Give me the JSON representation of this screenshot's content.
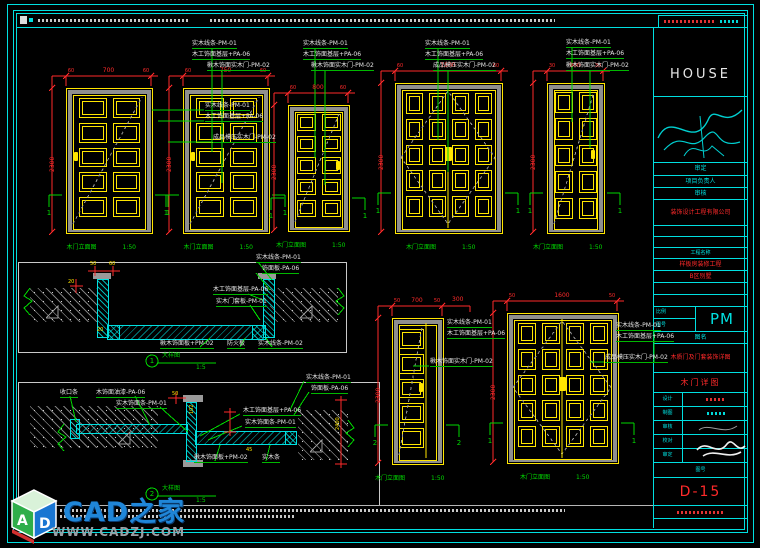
{
  "colors": {
    "cyan": "#00dfe0",
    "yellow": "#ffe600",
    "red": "#ff2a2a",
    "green": "#00d900",
    "gray": "#9a9a9a",
    "white": "#e6e6e6",
    "wm_blue": "#1f86d8"
  },
  "logo": {
    "text": "HOUSE"
  },
  "watermark": {
    "brand": "CAD之家",
    "url": "WWW.CADZJ.COM",
    "cube_letter_a": "A",
    "cube_letter_d": "D"
  },
  "title_block": {
    "logo": "HOUSE",
    "r1": "审定",
    "r2": "项目负责人",
    "r3": "审核",
    "company": "装饰设计工程有限公司",
    "proj_label": "工程名称",
    "proj1": "样板房装修工程",
    "proj2": "B区别墅",
    "scale_label": "比例",
    "no_label": "图号",
    "pm": "PM",
    "name_label": "图名",
    "sheet_long": "木质门及门套装饰详图",
    "sheet": "木门详图",
    "sig": [
      "设计",
      "制图",
      "审核",
      "校对",
      "审定"
    ],
    "no_label2": "图号",
    "number": "D-15"
  },
  "doors": [
    {
      "x": 66,
      "y": 88,
      "w": 85,
      "h": 144,
      "cols": 2,
      "rows": 5,
      "leaves": 1,
      "handle": "l",
      "dim_top": "700",
      "dim_sides": [
        "60",
        "60"
      ],
      "dim_left": "2300",
      "section": "1",
      "caption": "木门立面图",
      "scale": "1:50",
      "pad": [
        12,
        12,
        9,
        16
      ]
    },
    {
      "x": 183,
      "y": 88,
      "w": 85,
      "h": 144,
      "cols": 2,
      "rows": 5,
      "leaves": 1,
      "handle": "l",
      "dim_top": "750",
      "dim_sides": [
        "60",
        "60"
      ],
      "dim_left": "2300",
      "section": "1",
      "caption": "木门立面图",
      "scale": "1:50",
      "pad": [
        12,
        12,
        9,
        16
      ]
    },
    {
      "x": 288,
      "y": 105,
      "w": 60,
      "h": 125,
      "cols": 2,
      "rows": 5,
      "leaves": 1,
      "handle": "r",
      "dim_top": "800",
      "dim_sides": [
        "60",
        "60"
      ],
      "dim_left": "2300",
      "section": "1",
      "caption": "木门立面图",
      "scale": "1:50",
      "pad": [
        8,
        8,
        8,
        14
      ]
    },
    {
      "x": 395,
      "y": 83,
      "w": 106,
      "h": 149,
      "cols": 4,
      "rows": 5,
      "leaves": 2,
      "handle": "c",
      "dim_top": "1500",
      "dim_sides": [
        "60",
        "60"
      ],
      "dim_left": "2300",
      "section": "1",
      "caption": "木门立面图",
      "scale": "1:50",
      "pad": [
        10,
        10,
        9,
        16
      ]
    },
    {
      "x": 547,
      "y": 83,
      "w": 56,
      "h": 149,
      "cols": 2,
      "rows": 5,
      "leaves": 1,
      "handle": "r",
      "dim_top": "900",
      "dim_sides": [
        "30",
        "30"
      ],
      "dim_left": "2300",
      "section": "1",
      "caption": "木门立面图",
      "scale": "1:50",
      "pad": [
        7,
        7,
        8,
        14
      ]
    },
    {
      "x": 392,
      "y": 318,
      "w": 50,
      "h": 145,
      "cols": 1,
      "rows": 5,
      "leaves": 1,
      "handle": "lc",
      "dim_top": "700",
      "dim_sides": [
        "50",
        "50"
      ],
      "dim_left": "2300",
      "section": "2",
      "divider": true,
      "caption": "木门立面图",
      "scale": "1:50",
      "pad": [
        6,
        19,
        10,
        16
      ]
    },
    {
      "x": 507,
      "y": 313,
      "w": 110,
      "h": 149,
      "cols": 4,
      "rows": 5,
      "leaves": 2,
      "handle": "c",
      "dim_top": "1600",
      "dim_sides": [
        "50",
        "50"
      ],
      "dim_left": "2300",
      "section": "1",
      "caption": "木门立面图",
      "scale": "1:50",
      "pad": [
        10,
        10,
        9,
        16
      ]
    }
  ],
  "labels": [
    [
      205,
      103,
      "实木线条-PM-01",
      "w",
      6,
      "u"
    ],
    [
      205,
      114,
      "木工饰面基层+PA-06",
      "w",
      6,
      "u"
    ],
    [
      213,
      135,
      "成品模压实木门-PM-02",
      "w",
      6,
      "u"
    ],
    [
      192,
      41,
      "实木线条-PM-01",
      "w",
      6,
      "u"
    ],
    [
      192,
      52,
      "木工饰面基层+PA-06",
      "w",
      6,
      "u"
    ],
    [
      207,
      63,
      "楸木饰面实木门-PM-02",
      "w",
      6,
      "u"
    ],
    [
      303,
      41,
      "实木线条-PM-01",
      "w",
      6,
      "u"
    ],
    [
      303,
      52,
      "木工饰面基层+PA-06",
      "w",
      6,
      "u"
    ],
    [
      311,
      63,
      "楸木饰面实木门-PM-02",
      "w",
      6,
      "u"
    ],
    [
      425,
      41,
      "实木线条-PM-01",
      "w",
      6,
      "u"
    ],
    [
      425,
      52,
      "木工饰面基层+PA-06",
      "w",
      6,
      "u"
    ],
    [
      433,
      63,
      "成品模压实木门-PM-02",
      "w",
      6,
      "u"
    ],
    [
      566,
      40,
      "实木线条-PM-01",
      "w",
      6,
      "u"
    ],
    [
      566,
      51,
      "木工饰面基层+PA-06",
      "w",
      6,
      "u"
    ],
    [
      566,
      63,
      "楸木饰面实木门-PM-02",
      "w",
      6,
      "u"
    ],
    [
      447,
      320,
      "实木线条-PM-01",
      "w",
      6,
      "u"
    ],
    [
      447,
      331,
      "木工饰面基层+PA-06",
      "w",
      6,
      "u"
    ],
    [
      430,
      359,
      "楸木饰面实木门-PM-02",
      "w",
      6,
      "u"
    ],
    [
      616,
      323,
      "实木线条-PM-01",
      "w",
      6,
      "u"
    ],
    [
      616,
      334,
      "木工饰面基层+PA-06",
      "w",
      6,
      "u"
    ],
    [
      605,
      355,
      "成品模压实木门-PM-02",
      "w",
      6,
      "u"
    ],
    [
      256,
      255,
      "实木线条-PM-01",
      "w",
      6,
      "u"
    ],
    [
      262,
      266,
      "饰面板-PA-06",
      "w",
      6,
      "u"
    ],
    [
      213,
      287,
      "木工饰面基层-PA-06",
      "w",
      6,
      "u"
    ],
    [
      216,
      299,
      "实木门套板-PM-01",
      "w",
      6,
      "u"
    ],
    [
      160,
      341,
      "楸木饰面板+PM-02",
      "w",
      6,
      "u"
    ],
    [
      227,
      341,
      "防火板",
      "w",
      6,
      "u"
    ],
    [
      258,
      341,
      "实木线条-PM-02",
      "w",
      6,
      "u"
    ],
    [
      162,
      353,
      "大样图",
      "g",
      6,
      ""
    ],
    [
      196,
      365,
      "1:5",
      "g",
      6,
      ""
    ],
    [
      152,
      358,
      "1",
      "g",
      7,
      "c"
    ],
    [
      60,
      390,
      "收口条",
      "w",
      6,
      "u"
    ],
    [
      96,
      390,
      "木饰面油漆-PA-06",
      "w",
      6,
      "u"
    ],
    [
      116,
      401,
      "实木饰面条-PM-01",
      "w",
      6,
      "u"
    ],
    [
      243,
      408,
      "木工饰面基层+PA-06",
      "w",
      6,
      "u"
    ],
    [
      245,
      420,
      "实木饰面条-PM-01",
      "w",
      6,
      "u"
    ],
    [
      306,
      375,
      "实木线条-PM-01",
      "w",
      6,
      "u"
    ],
    [
      311,
      386,
      "饰面板-PA-06",
      "w",
      6,
      "u"
    ],
    [
      194,
      455,
      "楸木饰面板+PM-02",
      "w",
      6,
      "u"
    ],
    [
      262,
      455,
      "实木条",
      "w",
      6,
      "u"
    ],
    [
      162,
      486,
      "大样图",
      "g",
      6,
      ""
    ],
    [
      196,
      498,
      "1:5",
      "g",
      6,
      ""
    ],
    [
      152,
      491,
      "2",
      "g",
      7,
      "c"
    ],
    [
      90,
      262,
      "50",
      "y",
      5,
      ""
    ],
    [
      109,
      262,
      "60",
      "y",
      5,
      ""
    ],
    [
      68,
      280,
      "20",
      "y",
      5,
      ""
    ],
    [
      97,
      328,
      "20",
      "y",
      5,
      ""
    ],
    [
      172,
      392,
      "50",
      "y",
      5,
      ""
    ],
    [
      190,
      414,
      "102",
      "y",
      5,
      "r"
    ],
    [
      246,
      448,
      "45",
      "y",
      5,
      ""
    ],
    [
      336,
      430,
      "2400",
      "y",
      5,
      "r"
    ],
    [
      452,
      297,
      "300",
      "r",
      6,
      ""
    ]
  ],
  "shapes": [
    [
      "l",
      152,
      110,
      204,
      110,
      "g"
    ],
    [
      "l",
      158,
      121,
      204,
      121,
      "g"
    ],
    [
      "l",
      168,
      142,
      212,
      142,
      "g"
    ],
    [
      "l",
      212,
      48,
      212,
      152,
      "g"
    ],
    [
      "l",
      222,
      70,
      222,
      183,
      "g"
    ],
    [
      "l",
      315,
      48,
      315,
      158,
      "g"
    ],
    [
      "l",
      325,
      70,
      325,
      185,
      "g"
    ],
    [
      "l",
      438,
      48,
      438,
      140,
      "g"
    ],
    [
      "l",
      448,
      70,
      448,
      172,
      "g"
    ],
    [
      "l",
      572,
      47,
      572,
      122,
      "g"
    ],
    [
      "l",
      590,
      70,
      590,
      148,
      "g"
    ],
    [
      "l",
      413,
      366,
      429,
      366,
      "g"
    ],
    [
      "l",
      590,
      362,
      604,
      362,
      "g"
    ],
    [
      "l",
      654,
      330,
      654,
      362,
      "g"
    ],
    [
      "p",
      [
        [
          30,
          288
        ],
        [
          24,
          296
        ],
        [
          32,
          301
        ],
        [
          24,
          308
        ],
        [
          30,
          315
        ]
      ],
      "g"
    ],
    [
      "p",
      [
        [
          338,
          288
        ],
        [
          344,
          296
        ],
        [
          336,
          301
        ],
        [
          344,
          308
        ],
        [
          338,
          315
        ]
      ],
      "g"
    ],
    [
      "p",
      [
        [
          64,
          424
        ],
        [
          58,
          432
        ],
        [
          66,
          437
        ],
        [
          58,
          444
        ],
        [
          64,
          451
        ]
      ],
      "g"
    ],
    [
      "p",
      [
        [
          348,
          420
        ],
        [
          354,
          428
        ],
        [
          346,
          433
        ],
        [
          354,
          440
        ],
        [
          348,
          447
        ]
      ],
      "g"
    ],
    [
      "c",
      152,
      361,
      6,
      "g"
    ],
    [
      "l",
      158,
      363,
      216,
      363,
      "g"
    ],
    [
      "c",
      152,
      494,
      6,
      "g"
    ],
    [
      "l",
      158,
      496,
      216,
      496,
      "g"
    ],
    [
      "l",
      258,
      262,
      272,
      280,
      "g"
    ],
    [
      "l",
      256,
      273,
      270,
      290,
      "g"
    ],
    [
      "l",
      248,
      294,
      263,
      300,
      "g"
    ],
    [
      "l",
      250,
      305,
      260,
      320,
      "g"
    ],
    [
      "l",
      200,
      347,
      210,
      338,
      "g"
    ],
    [
      "l",
      240,
      347,
      245,
      338,
      "g"
    ],
    [
      "l",
      272,
      347,
      266,
      338,
      "g"
    ],
    [
      "l",
      70,
      396,
      76,
      422,
      "g"
    ],
    [
      "l",
      135,
      396,
      150,
      425,
      "g"
    ],
    [
      "l",
      160,
      407,
      188,
      432,
      "g"
    ],
    [
      "l",
      240,
      414,
      200,
      436,
      "g"
    ],
    [
      "l",
      242,
      426,
      208,
      440,
      "g"
    ],
    [
      "l",
      304,
      381,
      290,
      410,
      "g"
    ],
    [
      "l",
      309,
      392,
      294,
      415,
      "g"
    ],
    [
      "l",
      215,
      461,
      220,
      445,
      "g"
    ],
    [
      "l",
      266,
      461,
      270,
      445,
      "g"
    ],
    [
      "p",
      [
        [
          46,
          318
        ],
        [
          58,
          306
        ],
        [
          58,
          318
        ],
        [
          46,
          318
        ]
      ],
      "gy"
    ],
    [
      "p",
      [
        [
          300,
          318
        ],
        [
          312,
          306
        ],
        [
          312,
          318
        ],
        [
          300,
          318
        ]
      ],
      "gy"
    ],
    [
      "p",
      [
        [
          118,
          444
        ],
        [
          130,
          432
        ],
        [
          130,
          444
        ],
        [
          118,
          444
        ]
      ],
      "gy"
    ],
    [
      "p",
      [
        [
          310,
          452
        ],
        [
          322,
          440
        ],
        [
          322,
          452
        ],
        [
          310,
          452
        ]
      ],
      "gy"
    ],
    [
      "l",
      95,
      266,
      95,
      276,
      "r"
    ],
    [
      "l",
      113,
      266,
      113,
      276,
      "r"
    ],
    [
      "l",
      88,
      271,
      120,
      271,
      "r"
    ],
    [
      "l",
      76,
      279,
      76,
      293,
      "r"
    ],
    [
      "l",
      70,
      286,
      83,
      286,
      "r"
    ],
    [
      "l",
      176,
      392,
      176,
      404,
      "r"
    ],
    [
      "l",
      168,
      398,
      186,
      398,
      "r"
    ],
    [
      "l",
      230,
      408,
      230,
      436,
      "r"
    ],
    [
      "l",
      224,
      412,
      236,
      412,
      "r"
    ],
    [
      "l",
      224,
      432,
      236,
      432,
      "r"
    ],
    [
      "l",
      341,
      396,
      341,
      468,
      "r"
    ],
    [
      "l",
      335,
      400,
      347,
      400,
      "r"
    ],
    [
      "l",
      335,
      464,
      347,
      464,
      "r"
    ],
    [
      "l",
      449,
      306,
      470,
      306,
      "r"
    ],
    [
      "l",
      470,
      306,
      470,
      312,
      "r"
    ]
  ],
  "rects": [
    [
      "box",
      18,
      262,
      327,
      89
    ],
    [
      "wall",
      30,
      288,
      68,
      34
    ],
    [
      "wall",
      270,
      288,
      68,
      34
    ],
    [
      "cy",
      97,
      279,
      10,
      57
    ],
    [
      "cy",
      263,
      279,
      10,
      57
    ],
    [
      "cap",
      93,
      273,
      18,
      6
    ],
    [
      "cap",
      258,
      273,
      18,
      6
    ],
    [
      "leaf",
      107,
      325,
      157,
      13
    ],
    [
      "cy",
      107,
      325,
      11,
      13
    ],
    [
      "cy",
      252,
      325,
      12,
      13
    ],
    [
      "box",
      18,
      382,
      360,
      122
    ],
    [
      "wall",
      30,
      406,
      128,
      42
    ],
    [
      "wall",
      298,
      410,
      50,
      50
    ],
    [
      "cap",
      183,
      395,
      20,
      7
    ],
    [
      "cap",
      183,
      460,
      20,
      7
    ],
    [
      "cy",
      186,
      402,
      9,
      58
    ],
    [
      "leaf",
      76,
      424,
      110,
      8
    ],
    [
      "leaf",
      195,
      431,
      100,
      12
    ],
    [
      "cy",
      285,
      431,
      10,
      12
    ],
    [
      "cy",
      70,
      419,
      8,
      18
    ]
  ]
}
